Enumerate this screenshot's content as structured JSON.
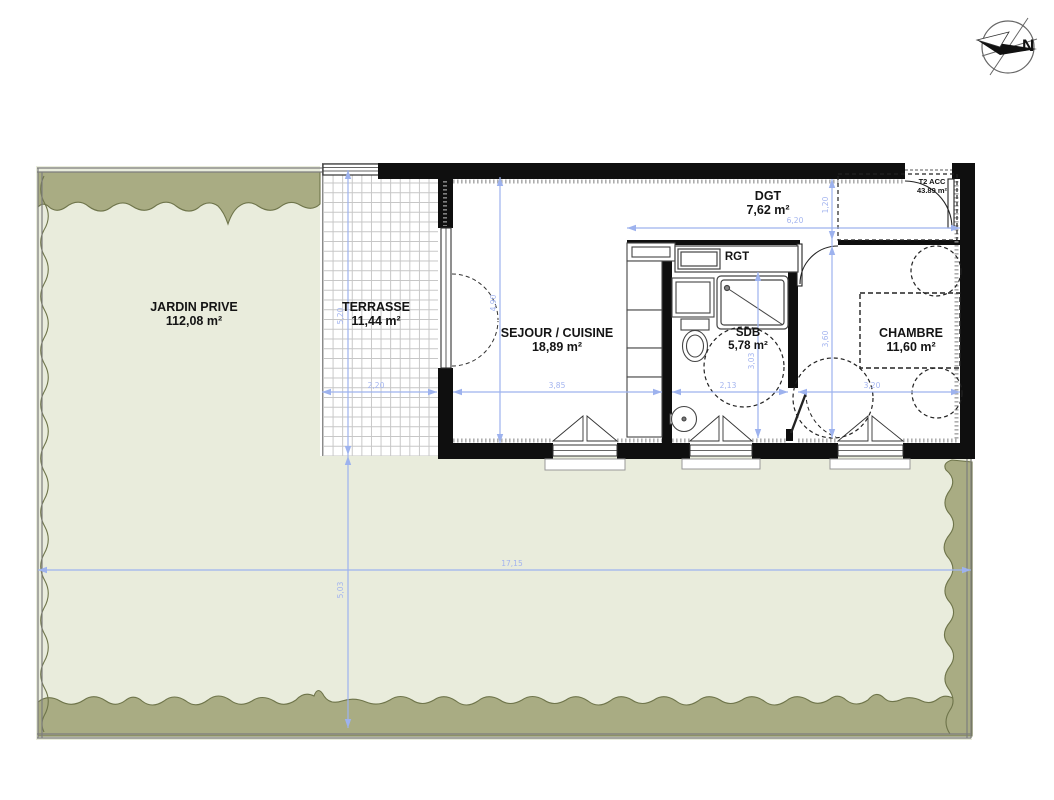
{
  "compass": {
    "north_label": "N"
  },
  "unit_tag": {
    "name": "T2 ACC",
    "area": "43.89 m²"
  },
  "rooms": {
    "jardin": {
      "name": "JARDIN PRIVE",
      "area": "112,08 m²"
    },
    "terrasse": {
      "name": "TERRASSE",
      "area": "11,44 m²"
    },
    "sejour": {
      "name": "SEJOUR / CUISINE",
      "area": "18,89 m²"
    },
    "dgt": {
      "name": "DGT",
      "area": "7,62 m²"
    },
    "rgt": {
      "name": "RGT"
    },
    "sdb": {
      "name": "SDB",
      "area": "5,78 m²"
    },
    "chambre": {
      "name": "CHAMBRE",
      "area": "11,60 m²"
    }
  },
  "dimensions": {
    "terrasse_width": "2,20",
    "terrasse_height": "5,20",
    "sejour_width": "3,85",
    "sejour_height": "4,90",
    "dgt_width": "6,20",
    "dgt_height": "1,20",
    "sdb_width": "2,13",
    "sdb_height": "3,03",
    "chambre_width": "3,20",
    "chambre_height": "3,60",
    "garden_width": "17,15",
    "garden_height": "5,03"
  },
  "colors": {
    "wall": "#0f0f0f",
    "dimension_blue": "#9db2ee",
    "garden_fill": "#e9ecdc",
    "hedge_fill": "#a9ac83",
    "hedge_line": "#6e744a"
  }
}
